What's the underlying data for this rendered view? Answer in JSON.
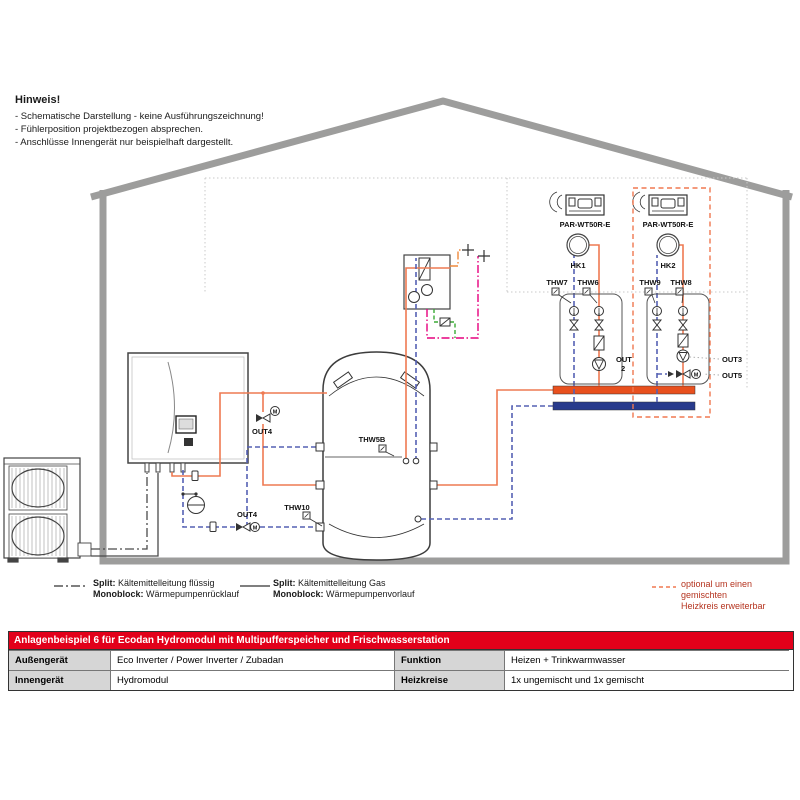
{
  "notice": {
    "title": "Hinweis!",
    "lines": [
      "- Schematische Darstellung - keine Ausführungszeichnung!",
      "- Fühlerposition projektbezogen absprechen.",
      "- Anschlüsse Innengerät nur beispielhaft dargestellt."
    ]
  },
  "labels": {
    "par1": "PAR-WT50R-E",
    "par2": "PAR-WT50R-E",
    "hk1": "HK1",
    "hk2": "HK2",
    "thw7": "THW7",
    "thw6": "THW6",
    "thw9": "THW9",
    "thw8": "THW8",
    "thw5b": "THW5B",
    "thw10": "THW10",
    "out2a": "OUT",
    "out2b": "2",
    "out3": "OUT3",
    "out5": "OUT5",
    "out4_flow": "OUT4",
    "out4_return": "OUT4",
    "m": "M"
  },
  "legend": {
    "items": [
      {
        "prefix1": "Split:",
        "text1": "Kältemittelleitung flüssig",
        "prefix2": "Monoblock:",
        "text2": "Wärmepumpenrücklauf"
      },
      {
        "prefix1": "Split:",
        "text1": "Kältemittelleitung Gas",
        "prefix2": "Monoblock:",
        "text2": "Wärmepumpenvorlauf"
      }
    ],
    "optional": {
      "line1": "optional um einen gemischten",
      "line2": "Heizkreis erweiterbar"
    }
  },
  "table": {
    "title": "Anlagenbeispiel 6 für Ecodan Hydromodul mit Multipufferspeicher und Frischwasserstation",
    "rows": [
      {
        "c1": "Außengerät",
        "c2": "Eco Inverter / Power Inverter / Zubadan",
        "c3": "Funktion",
        "c4": "Heizen + Trinkwarmwasser"
      },
      {
        "c1": "Innengerät",
        "c2": "Hydromodul",
        "c3": "Heizkreise",
        "c4": "1x ungemischt und 1x gemischt"
      }
    ]
  },
  "colors": {
    "brand_red": "#e2001a",
    "pipe_flow_orange": "#ee7a52",
    "pipe_return_blue": "#5560b4",
    "manifold_flow": "#e8501e",
    "manifold_return": "#283a8c",
    "dhw_cold": "#ef8a3d",
    "dhw_warm_magenta": "#e6007e",
    "circulation_green": "#3aaa35",
    "optional_dashed": "#f07850",
    "house_gray": "#9d9d9c"
  }
}
